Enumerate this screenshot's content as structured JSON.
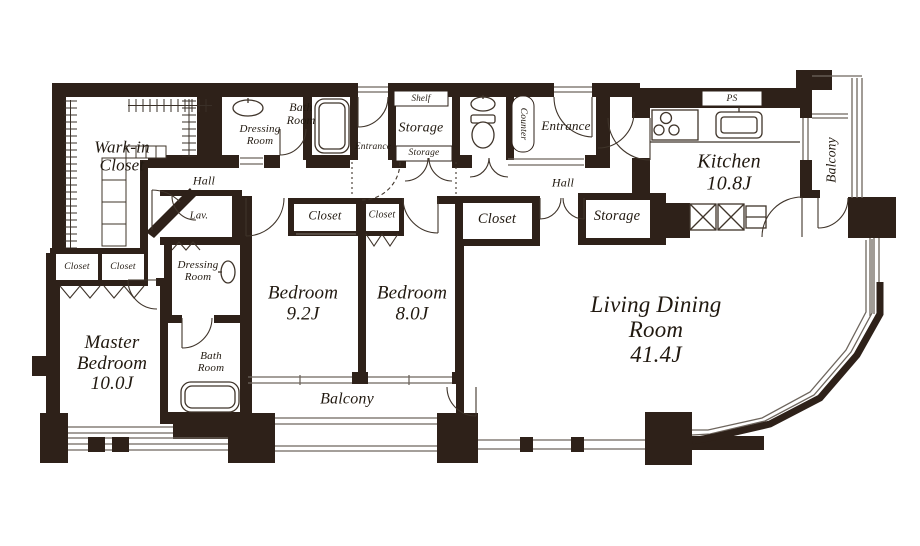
{
  "colors": {
    "wall": "#2e2119",
    "stroke": "#3f342a",
    "glass": "#6e665e",
    "ink": "#211910"
  },
  "rooms": {
    "walk_in_closet": {
      "label": "Wark-in\nCloset"
    },
    "dressing_room_top": {
      "label": "Dressing\nRoom"
    },
    "bath_room_top": {
      "label": "Bath\nRoom"
    },
    "service_entrance": {
      "label": "Entrance"
    },
    "shelf": {
      "label": "Shelf"
    },
    "storage_top": {
      "label": "Storage"
    },
    "storage_top_small": {
      "label": "Storage"
    },
    "counter": {
      "label": "Counter"
    },
    "entrance": {
      "label": "Entrance"
    },
    "hall_west": {
      "label": "Hall"
    },
    "hall_east": {
      "label": "Hall"
    },
    "lavatory": {
      "label": "Lav."
    },
    "closet_master_1": {
      "label": "Closet"
    },
    "closet_master_2": {
      "label": "Closet"
    },
    "dressing_room_lower": {
      "label": "Dressing\nRoom"
    },
    "bath_room_lower": {
      "label": "Bath\nRoom"
    },
    "master_bedroom": {
      "label": "Master\nBedroom\n10.0J"
    },
    "bedroom_92": {
      "label": "Bedroom\n9.2J"
    },
    "bedroom_80": {
      "label": "Bedroom\n8.0J"
    },
    "closet_92": {
      "label": "Closet"
    },
    "closet_80": {
      "label": "Closet"
    },
    "closet_hall": {
      "label": "Closet"
    },
    "storage_hall": {
      "label": "Storage"
    },
    "kitchen": {
      "label": "Kitchen\n10.8J"
    },
    "ps": {
      "label": "PS"
    },
    "living_dining": {
      "label": "Living Dining\nRoom\n41.4J"
    },
    "balcony_south": {
      "label": "Balcony"
    },
    "balcony_east": {
      "label": "Balcony"
    }
  }
}
